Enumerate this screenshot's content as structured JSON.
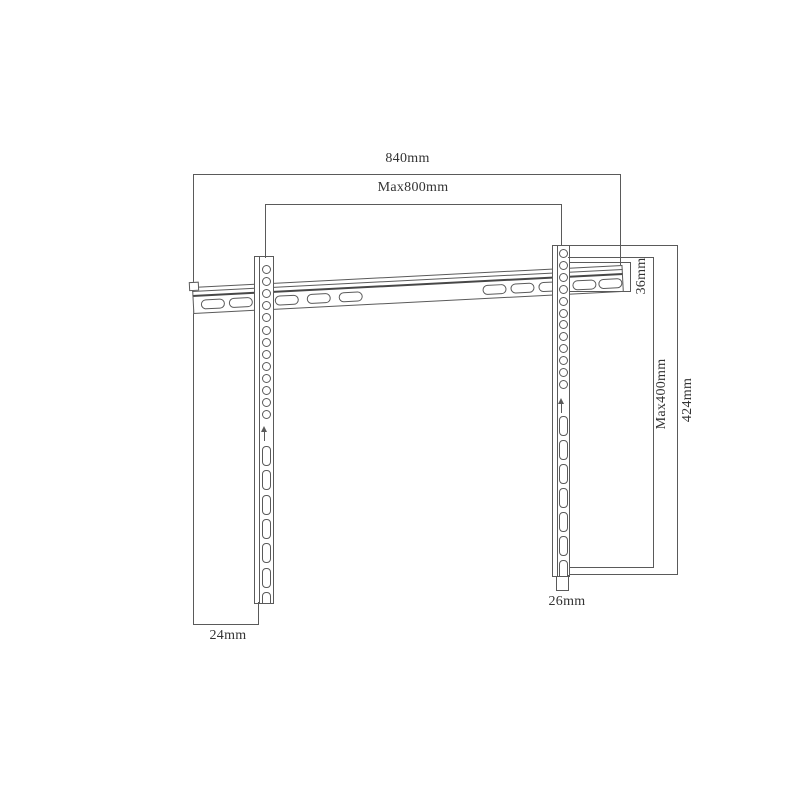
{
  "drawing": {
    "subject": "tv-wall-mount-bracket-dimension-drawing"
  },
  "colors": {
    "line": "#5a5a5a",
    "line_dark": "#474747",
    "text": "#333333",
    "background": "#ffffff"
  },
  "dimensions": {
    "total_width": "840mm",
    "max_width": "Max800mm",
    "rail_height": "36mm",
    "max_height": "Max400mm",
    "bracket_height": "424mm",
    "right_offset": "26mm",
    "left_offset": "24mm"
  },
  "diagram": {
    "rail": {
      "slot_positions": [
        8,
        36,
        82,
        114,
        146,
        290,
        318,
        346,
        380,
        406
      ]
    },
    "brackets": [
      {
        "side": "left",
        "round_holes": 13,
        "slot_holes": 7
      },
      {
        "side": "right",
        "round_holes": 12,
        "slot_holes": 7
      }
    ]
  }
}
